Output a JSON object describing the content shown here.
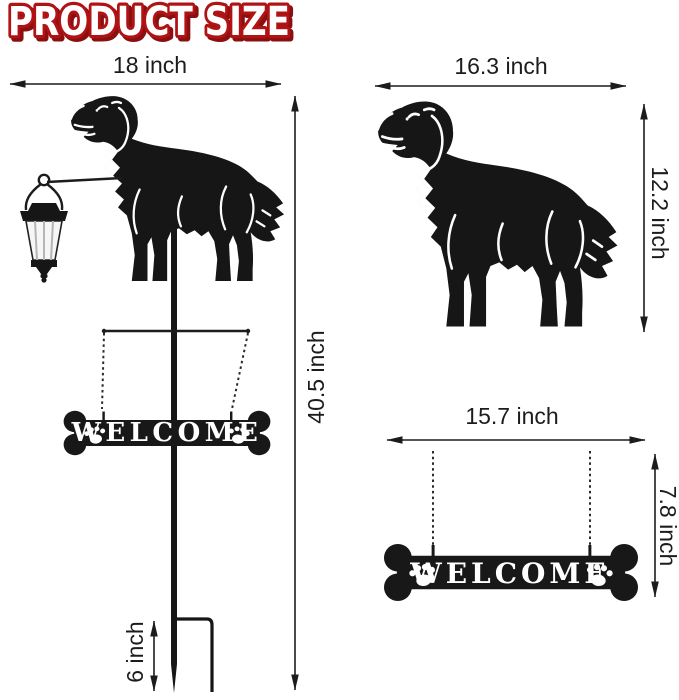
{
  "title": {
    "text": "PRODUCT SIZE"
  },
  "colors": {
    "title_fill": "#ffffff",
    "title_outline": "#b11315",
    "title_shadow": "#8a0f10",
    "silhouette": "#161616",
    "dimension_ink": "#1c1c1c",
    "sign_letters": "#ffffff",
    "lantern_glass": "#f6f6f6",
    "background": "#ffffff"
  },
  "left_assembly": {
    "width_label": "18 inch",
    "height_label": "40.5 inch",
    "stake_label": "6 inch",
    "sign_text": "WELCOME"
  },
  "dog_cutout": {
    "width_label": "16.3 inch",
    "height_label": "12.2 inch"
  },
  "sign_cutout": {
    "width_label": "15.7 inch",
    "height_label": "7.8 inch",
    "sign_text": "WELCOME"
  },
  "icons": {
    "dog": "dog-silhouette",
    "lantern": "solar-lantern-icon",
    "sign": "bone-welcome-sign",
    "paw": "paw-print-icon",
    "stake": "ground-stake",
    "chain": "hanging-chain",
    "arrow": "dimension-arrow"
  }
}
